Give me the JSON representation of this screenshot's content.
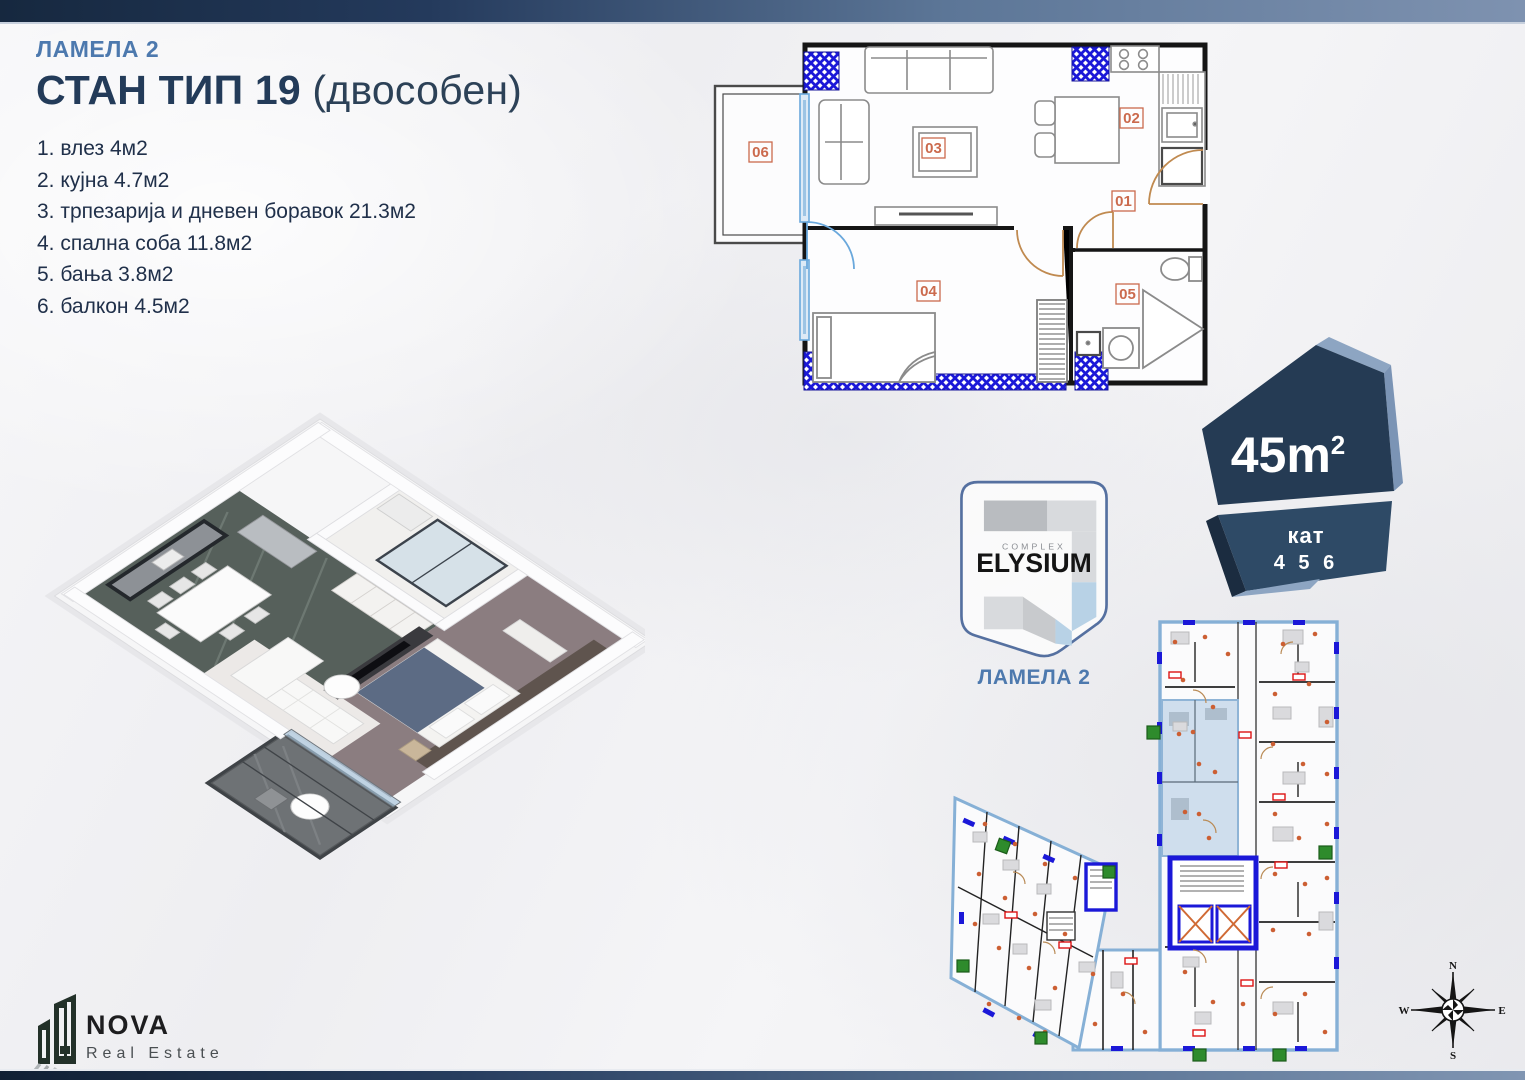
{
  "header": {
    "lamela": "ЛАМЕЛА 2",
    "title": "СТАН ТИП 19",
    "title_suffix": " (двособен)"
  },
  "room_list": {
    "items": [
      "1. влез 4м2",
      "2. кујна 4.7м2",
      "3. трпезарија и дневен боравок 21.3м2",
      "4. спална соба 11.8м2",
      "5. бања 3.8м2",
      "6. балкон 4.5м2"
    ]
  },
  "floorplan": {
    "labels": {
      "entry": "01",
      "kitchen": "02",
      "living": "03",
      "bedroom": "04",
      "bath": "05",
      "balcony": "06"
    }
  },
  "badge": {
    "area_value": "45m",
    "area_sup": "2",
    "floor_label": "кат",
    "floor_numbers": "4 5 6"
  },
  "elysium": {
    "complex": "COMPLEX",
    "name": "ELYSIUM",
    "lamela": "ЛАМЕЛА 2"
  },
  "compass": {
    "n": "N",
    "e": "E",
    "s": "S",
    "w": "W"
  },
  "nova": {
    "name": "NOVA",
    "tagline": "Real Estate"
  },
  "colors": {
    "accent_blue": "#4d79ae",
    "navy": "#233b59",
    "plan_wall_blue": "#1b18d8",
    "label_orange": "#cb6a4d",
    "badge_dark": "#253b54",
    "badge_mid": "#2e4a66",
    "badge_light": "#8da5c2",
    "highlight_unit": "#cfdeed"
  }
}
